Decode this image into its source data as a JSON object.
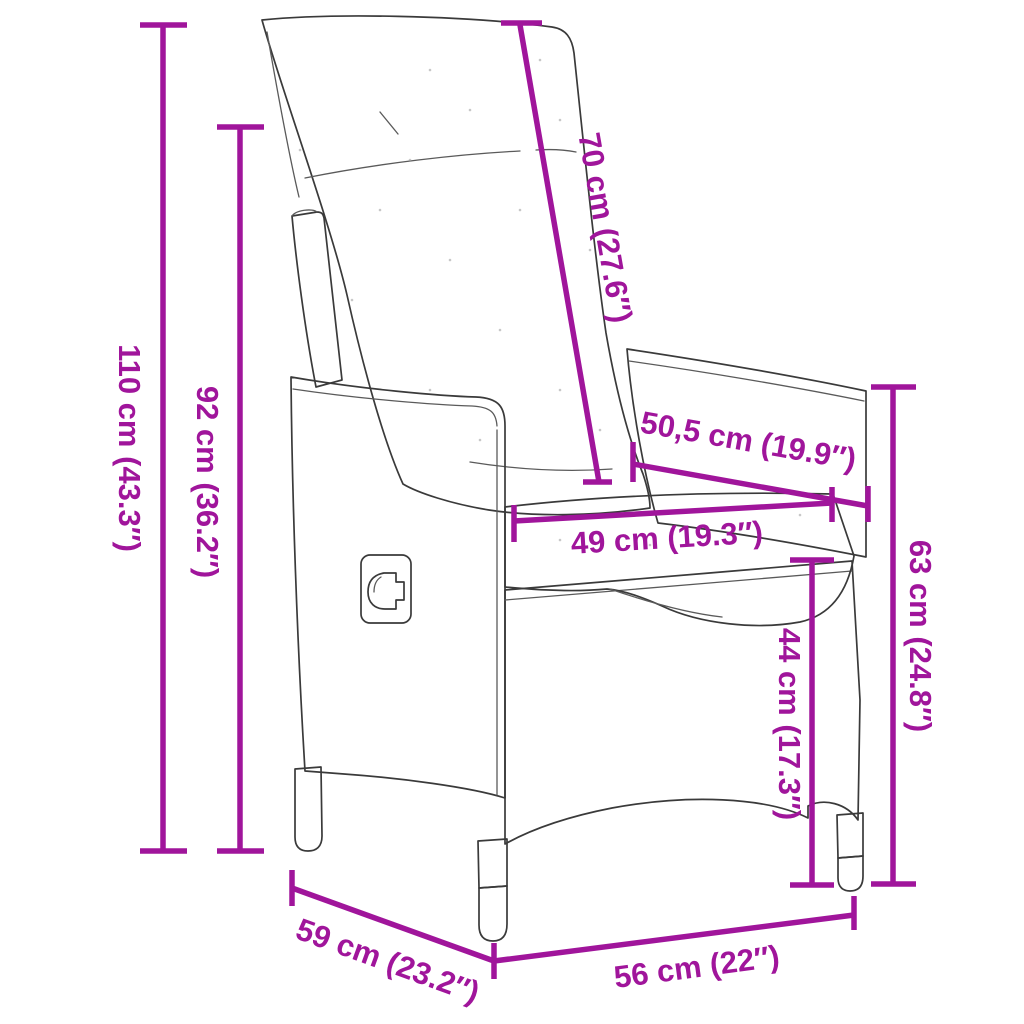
{
  "subject": "reclining-poly-rattan-garden-chair-dimension-diagram",
  "colors": {
    "dimension_accent": "#A0159B",
    "drawing_outline": "#3A3A3A",
    "cushion_fill": "#FCFCF9",
    "background": "#FFFFFF"
  },
  "dims": {
    "h110": {
      "label": "110 cm (43.3″)"
    },
    "h92": {
      "label": "92 cm (36.2″)"
    },
    "b70": {
      "label": "70 cm (27.6″)"
    },
    "d505": {
      "label": "50,5 cm (19.9″)"
    },
    "w49": {
      "label": "49 cm (19.3″)"
    },
    "h63": {
      "label": "63 cm (24.8″)"
    },
    "h44": {
      "label": "44 cm (17.3″)"
    },
    "d59": {
      "label": "59 cm (23.2″)"
    },
    "w56": {
      "label": "56 cm (22″)"
    }
  }
}
